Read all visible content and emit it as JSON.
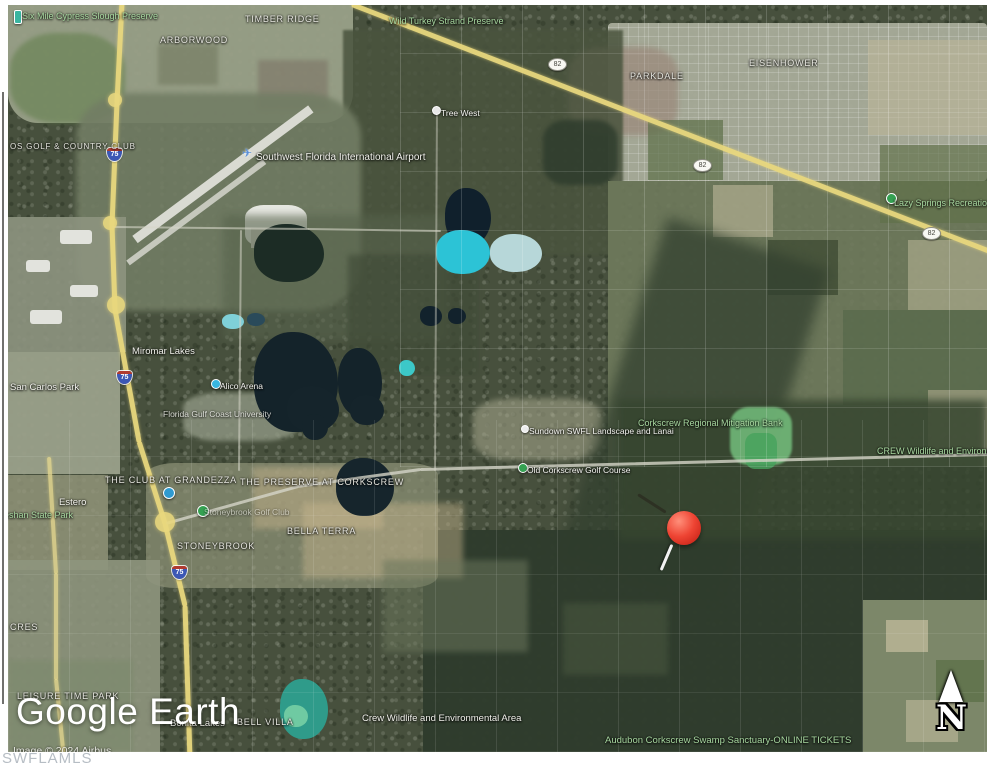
{
  "watermark": {
    "logo_text": "Google Earth",
    "imagery_credit": "Image © 2024 Airbus",
    "mls_watermark": "SWFLAMLS"
  },
  "compass": {
    "north_label": "N"
  },
  "marker": {
    "name": "red-pushpin",
    "color": "#e8392c"
  },
  "map": {
    "colors": {
      "highway_yellow": "#e9d87e",
      "minor_road": "#d5d5c8",
      "park_label_green": "#a8d8a0",
      "place_label_white": "#f2f2ec",
      "water_dark": "#10202c",
      "water_cyan": "#2cc3d6",
      "interstate_shield_blue": "#3c57b5"
    },
    "labels": [
      {
        "id": "six-mile-cypress-slough-preserve",
        "text": "Six Mile Cypress Slough Preserve",
        "type": "park",
        "x": 14,
        "y": 6
      },
      {
        "id": "timber-ridge",
        "text": "TIMBER RIDGE",
        "type": "district",
        "x": 237,
        "y": 9
      },
      {
        "id": "arborwood",
        "text": "ARBORWOOD",
        "type": "district",
        "x": 152,
        "y": 30
      },
      {
        "id": "wild-turkey-strand-preserve",
        "text": "Wild Turkey Strand Preserve",
        "type": "park",
        "x": 381,
        "y": 11
      },
      {
        "id": "parkdale",
        "text": "PARKDALE",
        "type": "district",
        "x": 622,
        "y": 66
      },
      {
        "id": "eisenhower",
        "text": "EISENHOWER",
        "type": "district",
        "x": 741,
        "y": 53
      },
      {
        "id": "tree-west",
        "text": "Tree West",
        "type": "poi",
        "x": 433,
        "y": 103
      },
      {
        "id": "swfl-international-airport",
        "text": "Southwest Florida International Airport",
        "type": "place",
        "x": 248,
        "y": 147,
        "size": 10
      },
      {
        "id": "lazy-springs-recreation-park",
        "text": "Lazy Springs Recreation Park",
        "type": "park",
        "x": 886,
        "y": 193
      },
      {
        "id": "os-golf-country-club",
        "text": "OS GOLF & COUNTRY CLUB",
        "type": "district",
        "x": 2,
        "y": 137,
        "size": 8
      },
      {
        "id": "miromar-lakes",
        "text": "Miromar Lakes",
        "type": "place",
        "x": 124,
        "y": 341
      },
      {
        "id": "san-carlos-park",
        "text": "San Carlos Park",
        "type": "place",
        "x": 2,
        "y": 377
      },
      {
        "id": "alico-arena",
        "text": "Alico Arena",
        "type": "poi",
        "x": 212,
        "y": 376
      },
      {
        "id": "florida-gulf-coast-university",
        "text": "Florida Gulf Coast University",
        "type": "poi",
        "x": 155,
        "y": 404,
        "opacity": 0.8
      },
      {
        "id": "corkscrew-regional-mitigation-bank",
        "text": "Corkscrew Regional Mitigation Bank",
        "type": "park",
        "x": 630,
        "y": 413
      },
      {
        "id": "sundown-swfl-landscape-and-lanai",
        "text": "Sundown SWFL Landscape and Lanai",
        "type": "poi",
        "x": 521,
        "y": 421
      },
      {
        "id": "crew-wildlife-and-environmental",
        "text": "CREW Wildlife and Environmental",
        "type": "park",
        "x": 869,
        "y": 441
      },
      {
        "id": "old-corkscrew-golf-course",
        "text": "Old Corkscrew Golf Course",
        "type": "poi",
        "x": 519,
        "y": 460
      },
      {
        "id": "the-club-at-grandezza",
        "text": "THE CLUB AT GRANDEZZA",
        "type": "district",
        "x": 97,
        "y": 470
      },
      {
        "id": "the-preserve-at-corkscrew",
        "text": "THE PRESERVE AT CORKSCREW",
        "type": "district",
        "x": 232,
        "y": 472
      },
      {
        "id": "estero",
        "text": "Estero",
        "type": "place",
        "x": 51,
        "y": 492
      },
      {
        "id": "koreshan-state-park",
        "text": "Koreshan State Park",
        "type": "park",
        "x": -18,
        "y": 505
      },
      {
        "id": "stoneybrook-golf-club",
        "text": "Stoneybrook Golf Club",
        "type": "poi",
        "x": 196,
        "y": 502,
        "opacity": 0.55
      },
      {
        "id": "bella-terra",
        "text": "BELLA TERRA",
        "type": "district",
        "x": 279,
        "y": 521
      },
      {
        "id": "stoneybrook",
        "text": "STONEYBROOK",
        "type": "district",
        "x": 169,
        "y": 536
      },
      {
        "id": "cres",
        "text": "CRES",
        "type": "district",
        "x": 2,
        "y": 617
      },
      {
        "id": "leisure-time-park",
        "text": "LEISURE TIME PARK",
        "type": "district",
        "x": 9,
        "y": 686
      },
      {
        "id": "bonita-lakes",
        "text": "Bonita Lakes",
        "type": "place",
        "x": 162,
        "y": 713
      },
      {
        "id": "bell-villa",
        "text": "BELL VILLA",
        "type": "district",
        "x": 229,
        "y": 712
      },
      {
        "id": "crew-wildlife-and-environmental-area",
        "text": "Crew Wildlife and Environmental Area",
        "type": "place",
        "x": 354,
        "y": 708
      },
      {
        "id": "audubon-corkscrew-swamp-sanctuary",
        "text": "Audubon Corkscrew Swamp Sanctuary-ONLINE TICKETS",
        "type": "park",
        "x": 597,
        "y": 730,
        "size": 9.5
      }
    ],
    "shields": [
      {
        "system": "interstate",
        "number": "75",
        "x": 99,
        "y": 143
      },
      {
        "system": "interstate",
        "number": "75",
        "x": 109,
        "y": 366
      },
      {
        "system": "interstate",
        "number": "75",
        "x": 164,
        "y": 561
      },
      {
        "system": "state",
        "number": "82",
        "x": 540,
        "y": 53
      },
      {
        "system": "state",
        "number": "82",
        "x": 685,
        "y": 154
      },
      {
        "system": "state",
        "number": "82",
        "x": 914,
        "y": 222
      }
    ],
    "pins": [
      {
        "id": "preserve-corner-pin",
        "x": 6,
        "y": 5,
        "w": 6,
        "h": 12,
        "color": "#3ab5a0",
        "shape": "bar"
      },
      {
        "id": "tree-west-pin",
        "x": 424,
        "y": 101,
        "w": 7,
        "h": 7,
        "color": "#e8e8e8"
      },
      {
        "id": "alico-arena-dot",
        "x": 203,
        "y": 374,
        "w": 8,
        "h": 8,
        "color": "#37b6e0"
      },
      {
        "id": "sundown-dot",
        "x": 513,
        "y": 420,
        "w": 6,
        "h": 6,
        "color": "#ececec"
      },
      {
        "id": "old-corkscrew-pin",
        "x": 510,
        "y": 458,
        "w": 8,
        "h": 8,
        "color": "#35a152"
      },
      {
        "id": "grandezza-pin",
        "x": 155,
        "y": 482,
        "w": 10,
        "h": 10,
        "color": "#2f9ad0"
      },
      {
        "id": "stoneybrook-pin",
        "x": 189,
        "y": 500,
        "w": 10,
        "h": 10,
        "color": "#35a152"
      },
      {
        "id": "lazy-springs-pin",
        "x": 878,
        "y": 188,
        "w": 9,
        "h": 9,
        "color": "#35a152"
      }
    ],
    "icons": [
      {
        "id": "airport-plane-icon",
        "glyph": "✈",
        "x": 234,
        "y": 141,
        "color": "#5a8fd8"
      }
    ]
  }
}
